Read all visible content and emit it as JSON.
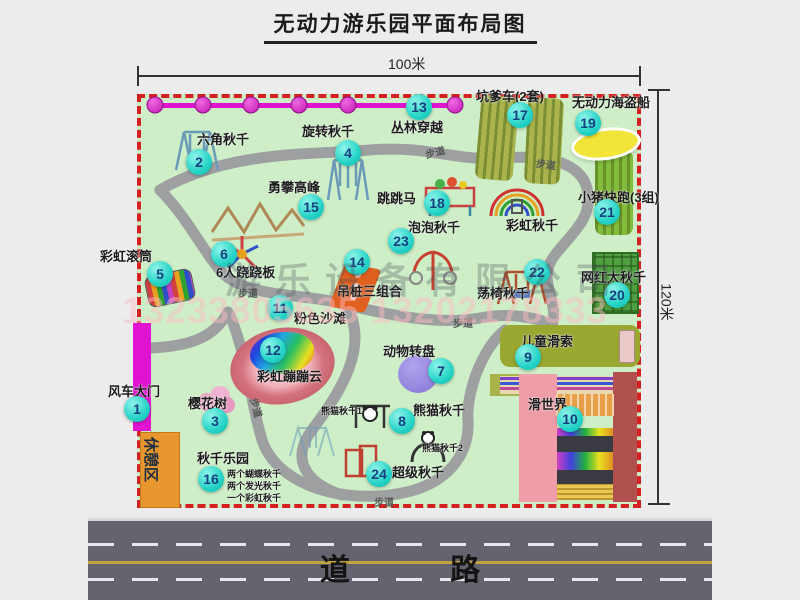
{
  "title": "无动力游乐园平面布局图",
  "dimensions": {
    "width_label": "100米",
    "height_label": "120米"
  },
  "road": {
    "label": "道 路"
  },
  "watermark": {
    "company": "游乐设备有限公司",
    "phone": "13233805635 13202178333"
  },
  "rest_area": {
    "label": "休憩区"
  },
  "extra_labels": {
    "rainbow_swing": "彩虹秋千",
    "footpath": "步道",
    "panda_swing_1": "熊猫秋千1",
    "panda_swing_2": "熊猫秋千2",
    "swing_park_note_1": "两个蝴蝶秋千",
    "swing_park_note_2": "两个发光秋千",
    "swing_park_note_3": "一个彩虹秋千"
  },
  "items": {
    "i1": {
      "num": "1",
      "label": "风车大门"
    },
    "i2": {
      "num": "2",
      "label": "六角秋千"
    },
    "i3": {
      "num": "3",
      "label": "樱花树"
    },
    "i4": {
      "num": "4",
      "label": "旋转秋千"
    },
    "i5": {
      "num": "5",
      "label": "彩虹滚筒"
    },
    "i6": {
      "num": "6",
      "label": "6人跷跷板"
    },
    "i7": {
      "num": "7",
      "label": "动物转盘"
    },
    "i8": {
      "num": "8",
      "label": "熊猫秋千"
    },
    "i9": {
      "num": "9",
      "label": "儿童滑索"
    },
    "i10": {
      "num": "10",
      "label": "滑世界"
    },
    "i11": {
      "num": "11",
      "label": "粉色沙滩"
    },
    "i12": {
      "num": "12",
      "label": "彩虹蹦蹦云"
    },
    "i13": {
      "num": "13",
      "label": "丛林穿越"
    },
    "i14": {
      "num": "14",
      "label": "吊桩三组合"
    },
    "i15": {
      "num": "15",
      "label": "勇攀高峰"
    },
    "i16": {
      "num": "16",
      "label": "秋千乐园"
    },
    "i17": {
      "num": "17",
      "label": "坑爹车(2套)"
    },
    "i18": {
      "num": "18",
      "label": "跳跳马"
    },
    "i19": {
      "num": "19",
      "label": "无动力海盗船"
    },
    "i20": {
      "num": "20",
      "label": "网红大秋千"
    },
    "i21": {
      "num": "21",
      "label": "小猪快跑(3组)"
    },
    "i22": {
      "num": "22",
      "label": "荡椅秋千"
    },
    "i23": {
      "num": "23",
      "label": "泡泡秋千"
    },
    "i24": {
      "num": "24",
      "label": "超级秋千"
    }
  },
  "colors": {
    "badge": "#25d3c6",
    "map_green": "#cdeec6",
    "border_red": "#d42020",
    "gate_magenta": "#e013d0",
    "road_gray": "#64646e",
    "rest_orange": "#e8962e"
  }
}
